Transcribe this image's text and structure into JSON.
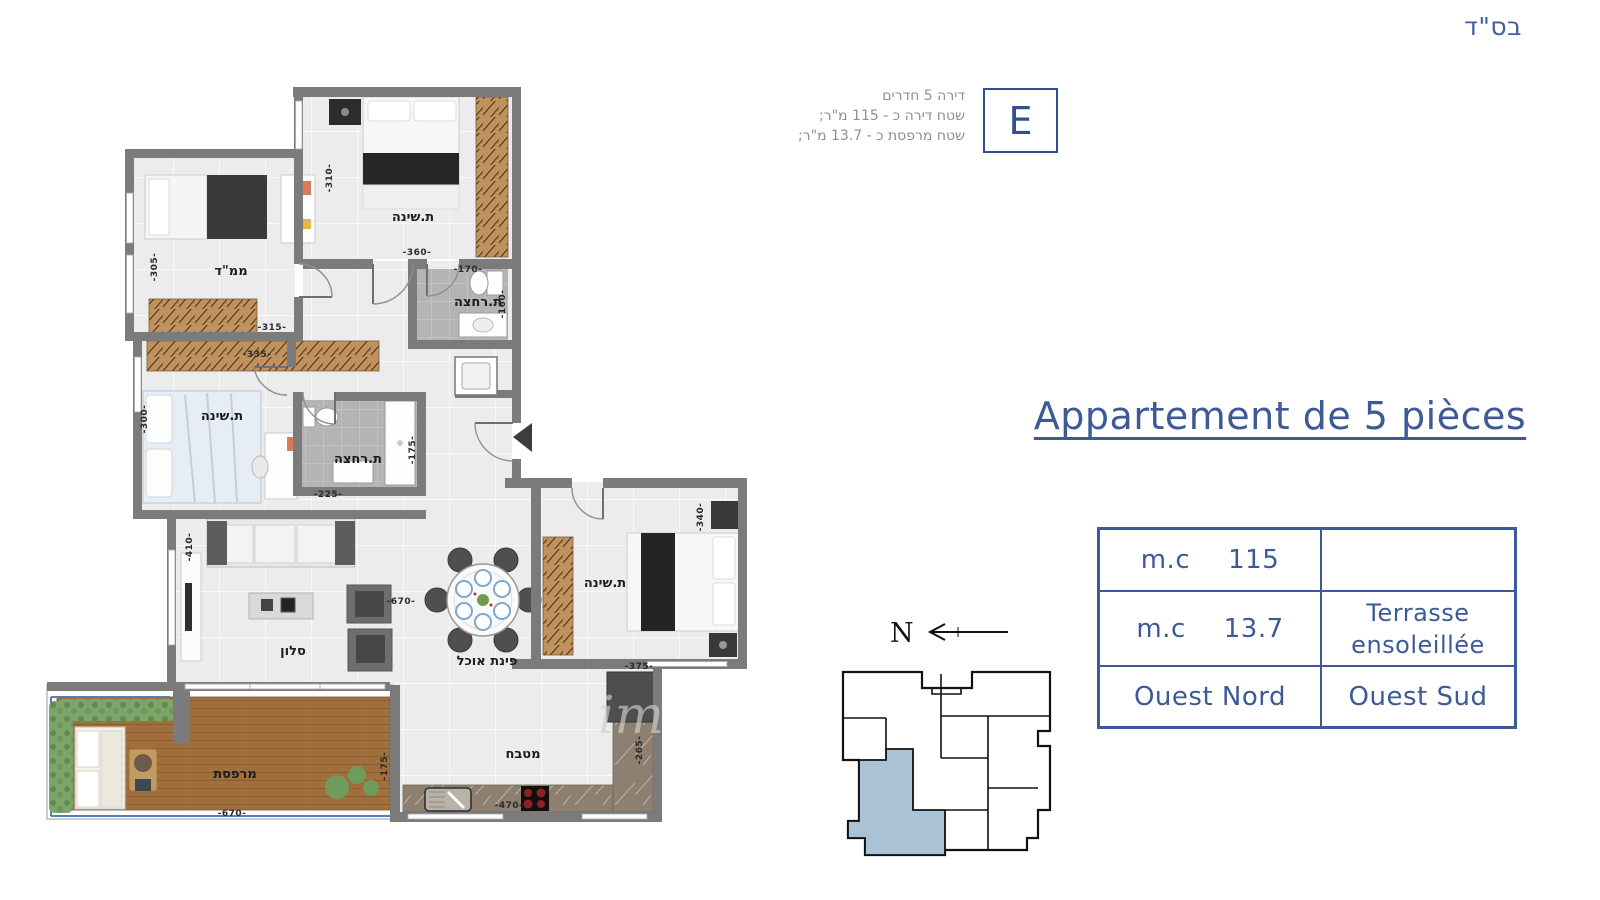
{
  "header": {
    "bsd": "בס\"ד"
  },
  "unit_badge": {
    "letter": "E",
    "desc_lines": [
      "דירה 5 חדרים",
      "שטח דירה כ - 115 מ\"ר;",
      "שטח מרפסת כ - 13.7 מ\"ר;"
    ]
  },
  "title": {
    "text": "Appartement de 5 pièces"
  },
  "spec_table": {
    "r1c1_label": "m.c",
    "r1c1_value": "115",
    "r1c2": "",
    "r2c1_label": "m.c",
    "r2c1_value": "13.7",
    "r2c2_line1": "Terrasse",
    "r2c2_line2": "ensoleillée",
    "r3c1": "Ouest Nord",
    "r3c2": "Ouest Sud"
  },
  "compass": {
    "north_label": "N"
  },
  "floor_plan": {
    "rooms": {
      "bedroom_top": "ת.שינה",
      "mamad": "ממ\"ד",
      "bath_top": "ת.רחצה",
      "bedroom_left": "ת.שינה",
      "bath_middle": "ת.רחצה",
      "living": "סלון",
      "dining": "פינת אוכל",
      "bedroom_right": "ת.שינה",
      "kitchen": "מטבח",
      "terrace": "מרפסת"
    },
    "dimensions": {
      "bedroom_top_w": "-310-",
      "bedroom_top_l": "-360-",
      "mamad_w": "-305-",
      "mamad_l": "-315-",
      "bath_top_l": "-170-",
      "bath_top_w": "-160-",
      "closet_l": "-335-",
      "bedroom_left_w": "-300-",
      "bath_middle_l": "-225-",
      "bath_middle_w": "-175-",
      "living_w": "-410-",
      "living_l": "-670-",
      "bedroom_right_w": "-340-",
      "bedroom_right_l": "-375-",
      "kitchen_l": "-470-",
      "kitchen_w": "-265-",
      "terrace_l": "-670-",
      "terrace_w": "-175-"
    },
    "watermark": "im"
  },
  "colors": {
    "accent_blue": "#3b5a96",
    "muted_text": "#8f8f8f",
    "highlight_unit": "#a9c2d6"
  }
}
